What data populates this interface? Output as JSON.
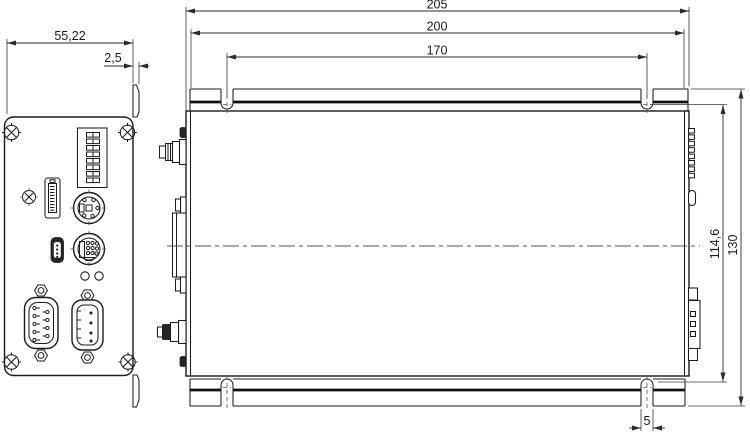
{
  "page": {
    "title": "Enclosure dimensional drawing",
    "background_color": "#ffffff",
    "line_color": "#1b1b1b",
    "dimension_color": "#2a2a2a"
  },
  "dims": {
    "d205": "205",
    "d200": "200",
    "d170": "170",
    "d55_22": "55,22",
    "d2_5": "2,5",
    "d114_6": "114,6",
    "d130": "130",
    "d5": "5"
  },
  "views": {
    "front_view": {
      "name": "front-panel-view",
      "features": [
        "corner-screw",
        "corner-screw",
        "corner-screw",
        "corner-screw",
        "dip-switch-8",
        "torx-screw",
        "display-connector",
        "mini-din-connector",
        "mini-usb-connector",
        "mini-din-connector",
        "led",
        "led",
        "db9-connector",
        "dsub-connector",
        "mounting-tab"
      ]
    },
    "side_view": {
      "name": "side-view",
      "features": [
        "top-mounting-flange",
        "bottom-mounting-flange",
        "mounting-slot",
        "mounting-slot",
        "mounting-slot",
        "mounting-slot",
        "coax-connector",
        "dsub-side",
        "coax-connector-nut",
        "dip-switch-side",
        "push-button-side",
        "dsub-side",
        "center-line"
      ]
    }
  }
}
